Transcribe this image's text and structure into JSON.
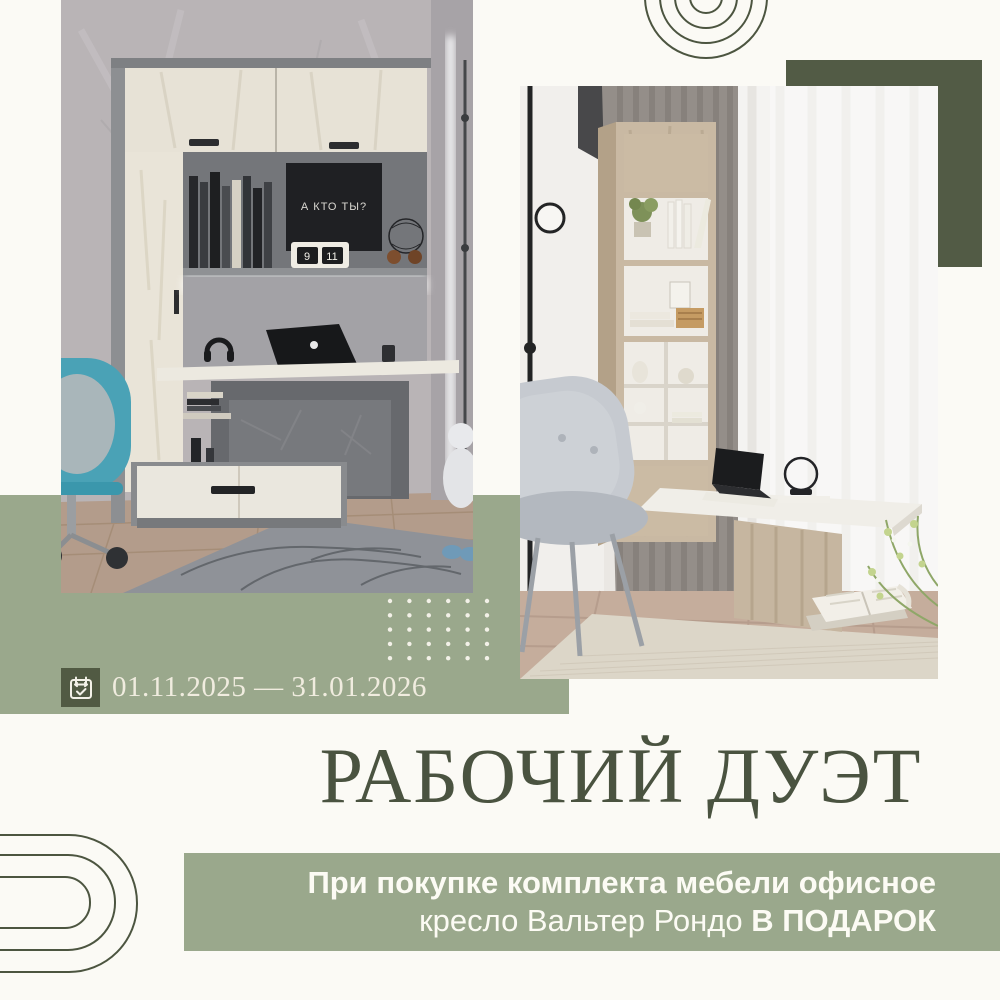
{
  "page": {
    "background": "#fbfaf5"
  },
  "palette": {
    "sage_green": "#9aa88c",
    "dark_green": "#515a43",
    "olive_text": "#4a5340",
    "cream_text": "#f0ecdf",
    "white_text": "#fcfbf4"
  },
  "promo": {
    "date_range": "01.11.2025 — 31.01.2026",
    "title": "РАБОЧИЙ ДУЭТ",
    "offer_line1": "При покупке комплекта мебели офисное",
    "offer_line2_regular": "кресло Вальтер Рондо ",
    "offer_line2_bold": "В ПОДАРОК"
  },
  "photo_left_details": {
    "poster_text": "А КТО ТЫ?",
    "flip_clock_left": "9",
    "flip_clock_right": "11"
  }
}
